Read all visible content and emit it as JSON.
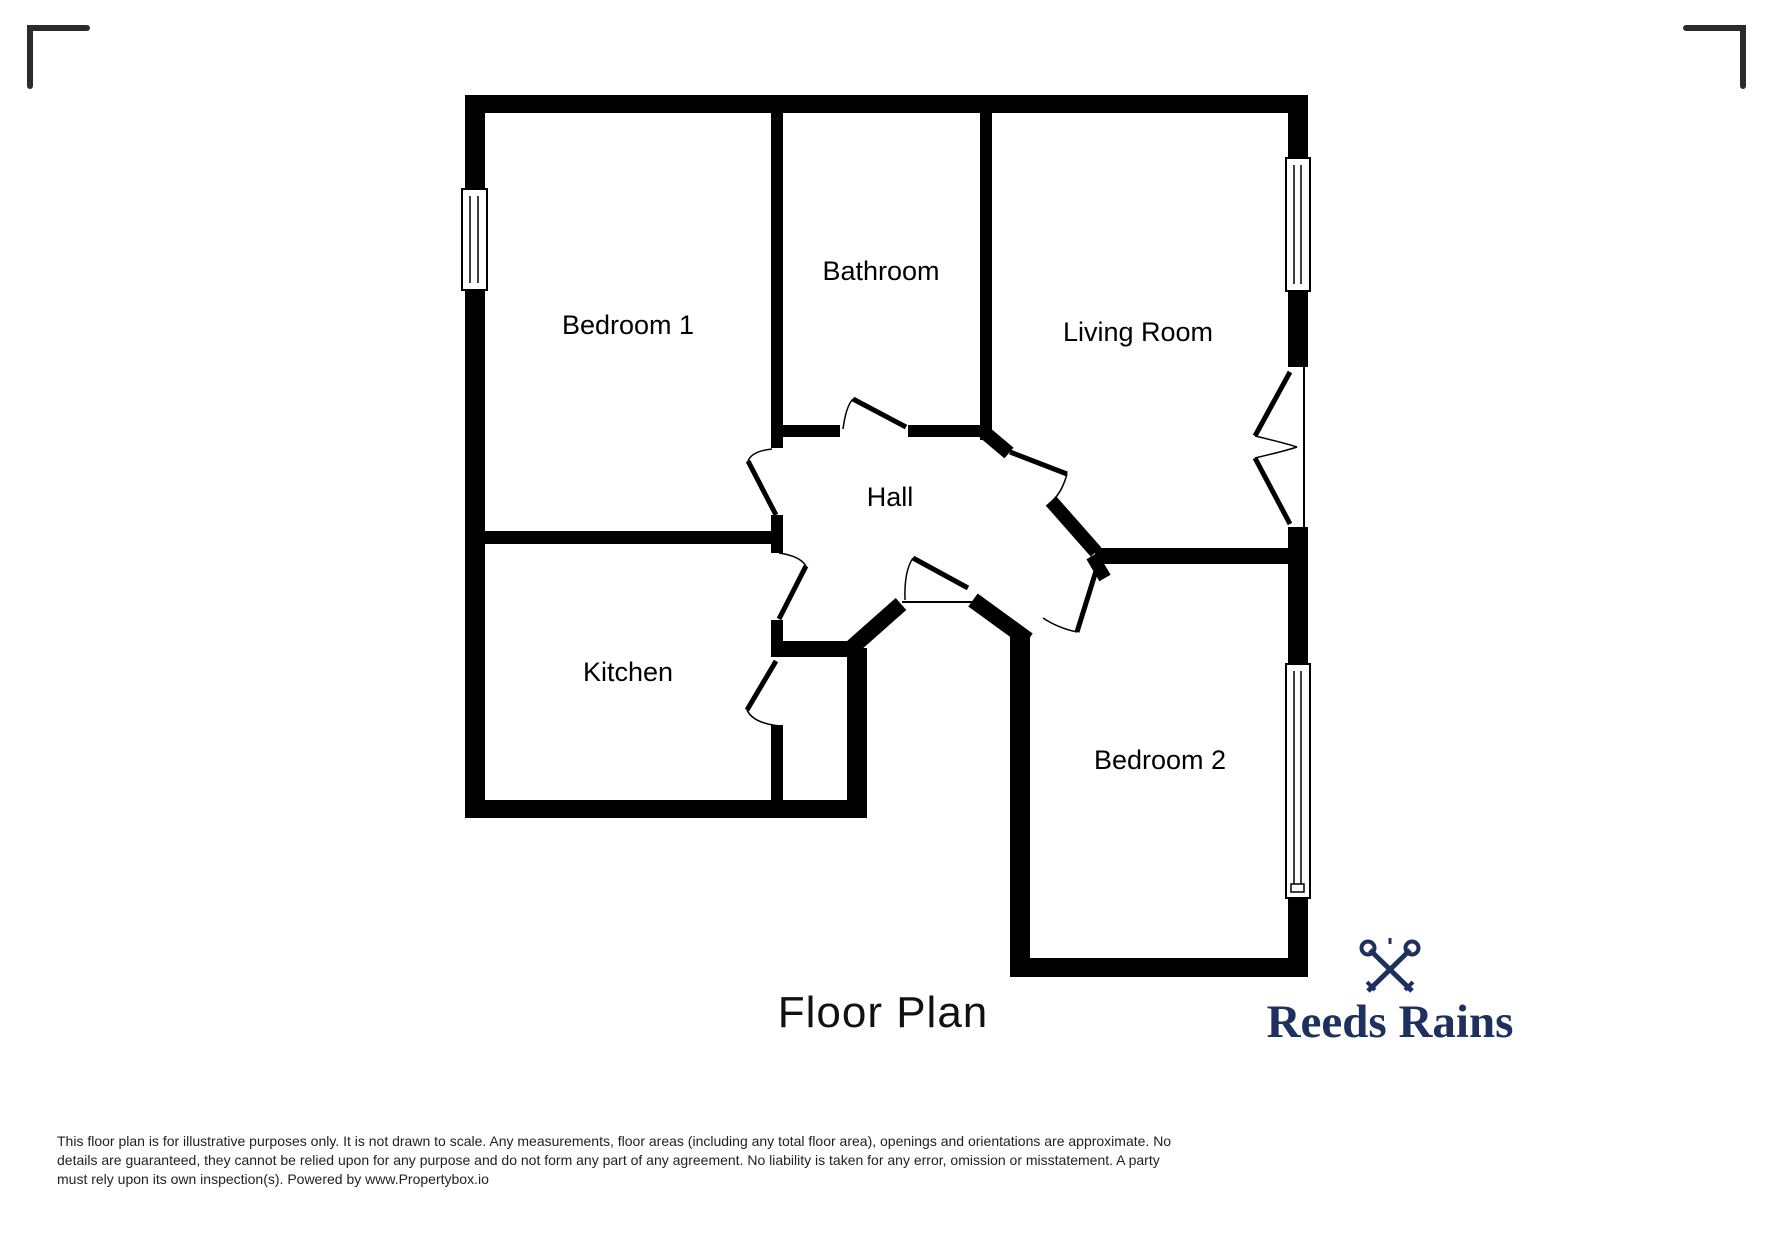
{
  "plan": {
    "rooms": [
      {
        "label": "Bedroom 1"
      },
      {
        "label": "Bathroom"
      },
      {
        "label": "Living Room"
      },
      {
        "label": "Hall"
      },
      {
        "label": "Kitchen"
      },
      {
        "label": "Bedroom 2"
      }
    ]
  },
  "title": "Floor Plan",
  "disclaimer": {
    "line1": "This floor plan is for illustrative purposes only. It is not drawn to scale. Any measurements, floor areas (including any total floor area), openings and orientations are approximate. No",
    "line2": "details are guaranteed, they cannot be relied upon for any purpose and do not form any part of any agreement. No liability is taken for any error, omission or misstatement. A party",
    "line3": "must rely upon its own inspection(s). Powered by www.Propertybox.io"
  },
  "brand": {
    "name": "Reeds Rains",
    "color": "#1d3060"
  },
  "colors": {
    "wall": "#000000",
    "corner_mark": "#2b2b2b",
    "background": "#ffffff"
  }
}
